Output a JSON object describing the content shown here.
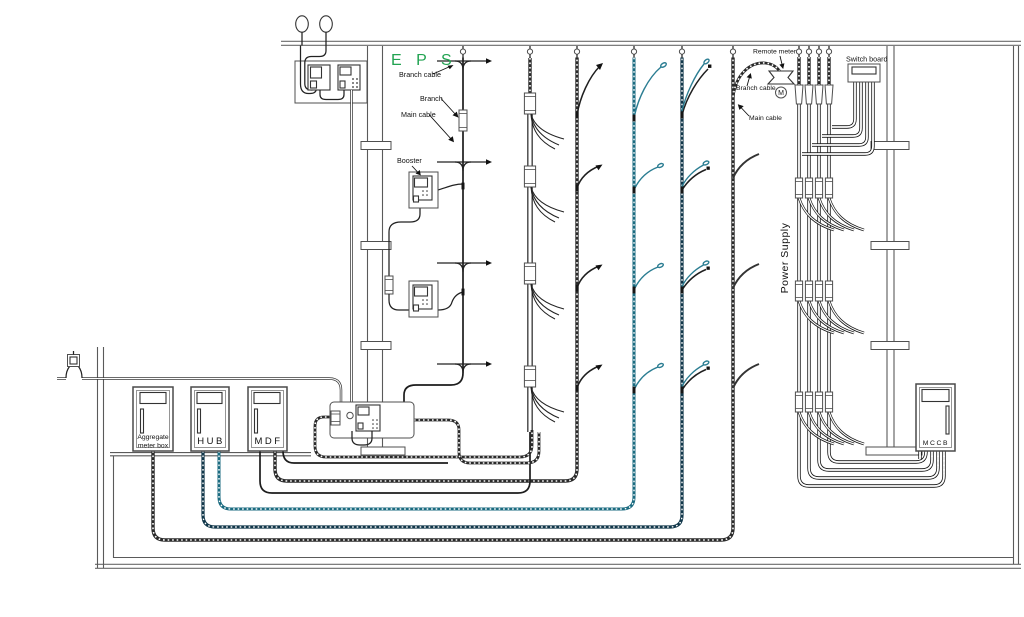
{
  "diagram": {
    "eps_title": "E P S",
    "labels": {
      "branch_cable": "Branch cable",
      "branch": "Branch",
      "main_cable": "Main cable",
      "booster": "Booster",
      "remote_meter": "Remote meter",
      "branch_cable_right": "Branch cable",
      "main_cable_right": "Main cable",
      "switch_board": "Switch board",
      "power_supply": "Power Supply",
      "meter_symbol": "M"
    },
    "boxes": {
      "aggregate_line1": "Aggregate",
      "aggregate_line2": "meter box",
      "hub": "HUB",
      "mdf": "MDF",
      "mccb": "MCCB"
    },
    "colors": {
      "eps_green": "#21a351",
      "teal": "#2b7d92",
      "dark_teal": "#11374a",
      "cable_dark": "#2a2a2a"
    }
  }
}
